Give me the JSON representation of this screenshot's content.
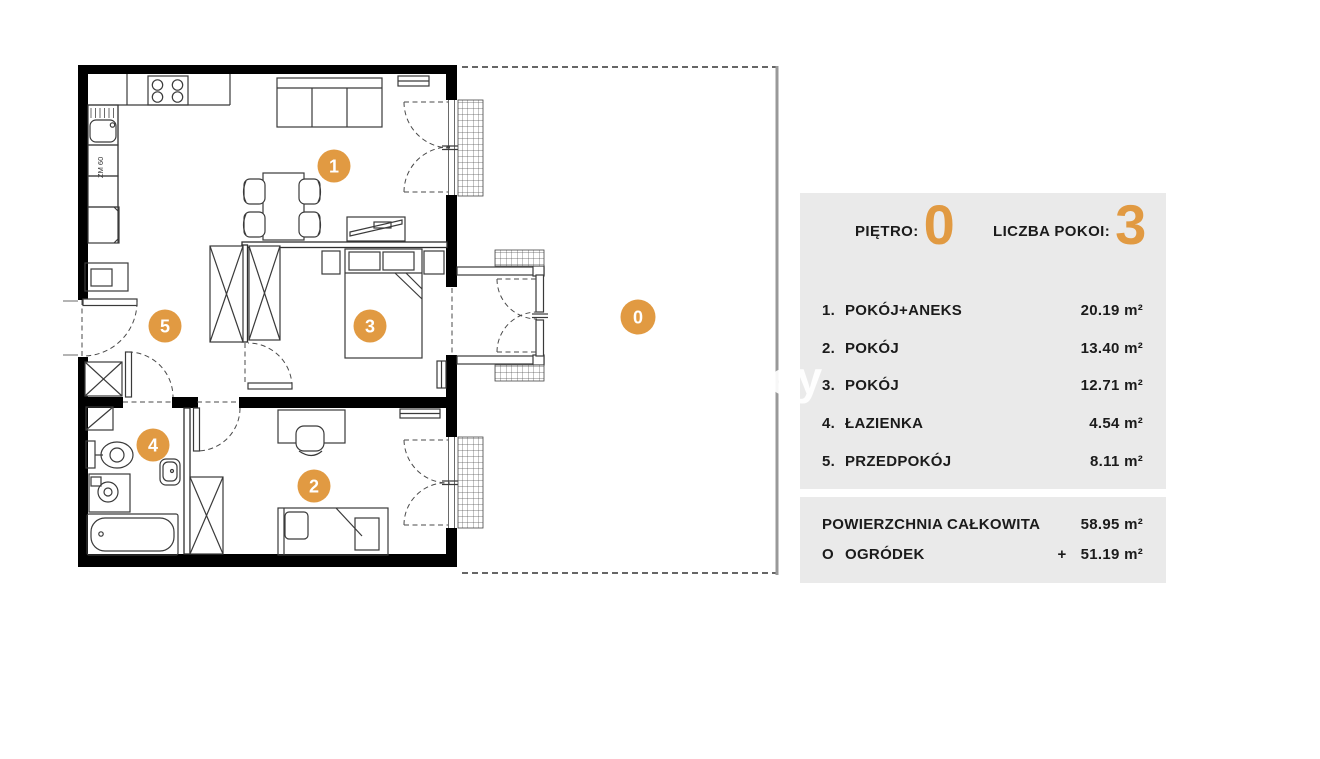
{
  "plan": {
    "badges": [
      {
        "id": "room-1",
        "label": "1"
      },
      {
        "id": "room-2",
        "label": "2"
      },
      {
        "id": "room-3",
        "label": "3"
      },
      {
        "id": "room-4",
        "label": "4"
      },
      {
        "id": "room-5",
        "label": "5"
      },
      {
        "id": "garden",
        "label": "0"
      }
    ],
    "labels": {
      "dishwasher": "ZM 60"
    },
    "colors": {
      "badge_orange": "#E19A42",
      "wall_black": "#000000",
      "garden_boundary_gray": "#999999",
      "panel_gray": "#EAEAEA"
    }
  },
  "watermark": "cy",
  "legend": {
    "floor_label": "PIĘTRO:",
    "floor_value": "0",
    "rooms_count_label": "LICZBA POKOI:",
    "rooms_count_value": "3",
    "rows": [
      {
        "num": "1.",
        "name": "POKÓJ+ANEKS",
        "area": "20.19 m²"
      },
      {
        "num": "2.",
        "name": "POKÓJ",
        "area": "13.40 m²"
      },
      {
        "num": "3.",
        "name": "POKÓJ",
        "area": "12.71 m²"
      },
      {
        "num": "4.",
        "name": "ŁAZIENKA",
        "area": "4.54 m²"
      },
      {
        "num": "5.",
        "name": "PRZEDPOKÓJ",
        "area": "8.11 m²"
      }
    ],
    "total": {
      "name": "POWIERZCHNIA CAŁKOWITA",
      "area": "58.95 m²"
    },
    "garden": {
      "num": "O",
      "name": "OGRÓDEK",
      "plus": "+",
      "area": "51.19 m²"
    }
  }
}
